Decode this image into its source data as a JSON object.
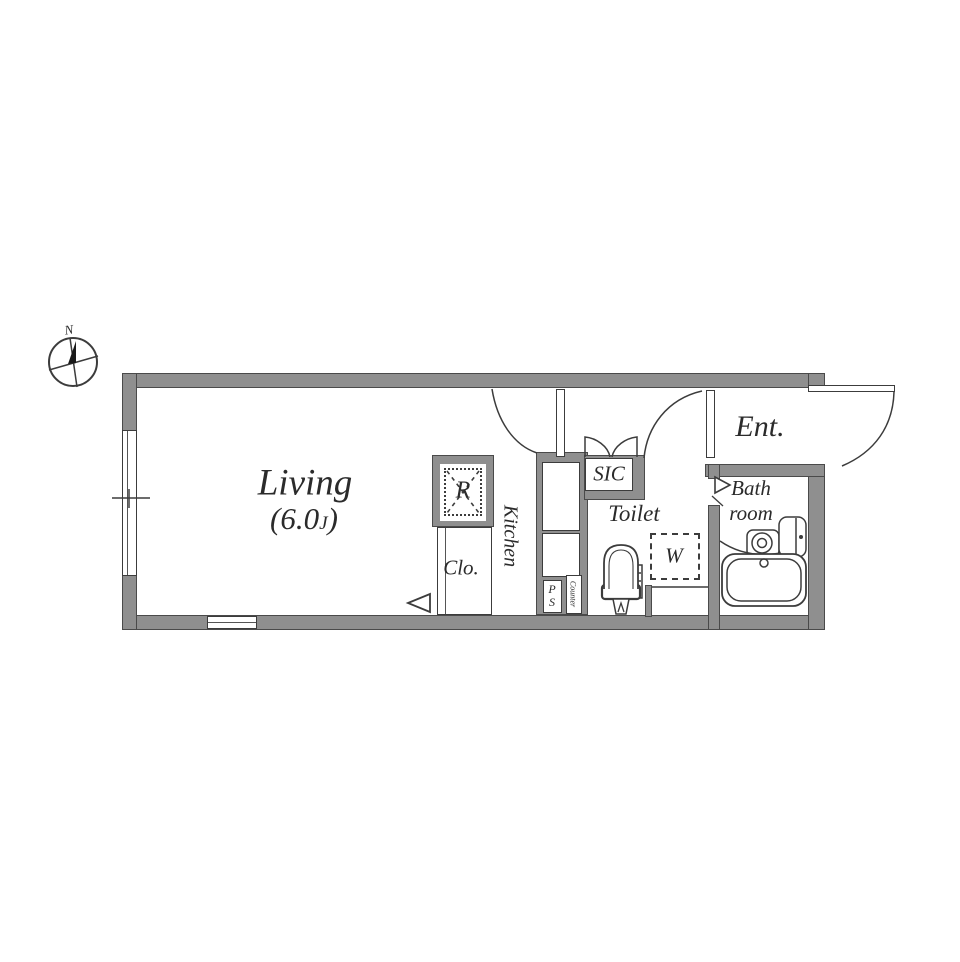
{
  "compass": {
    "north_label": "N"
  },
  "rooms": {
    "living": {
      "name": "Living",
      "size_open": "(6.0",
      "size_unit": "J",
      "size_close": ")"
    },
    "kitchen": {
      "name": "Kitchen"
    },
    "closet": {
      "name": "Clo."
    },
    "refrigerator": {
      "name": "R"
    },
    "sic": {
      "name": "SIC"
    },
    "toilet": {
      "name": "Toilet"
    },
    "washer": {
      "name": "W"
    },
    "entrance": {
      "name": "Ent."
    },
    "bathroom": {
      "line1": "Bath",
      "line2": "room"
    },
    "pipe_space": {
      "line1": "P",
      "line2": "S"
    },
    "counter": {
      "name": "Counter"
    }
  },
  "colors": {
    "background": "#ffffff",
    "wall_fill": "#8f8f8f",
    "wall_outline": "#4a4a4a",
    "line": "#3c3c3c",
    "text": "#2b2b2b"
  }
}
